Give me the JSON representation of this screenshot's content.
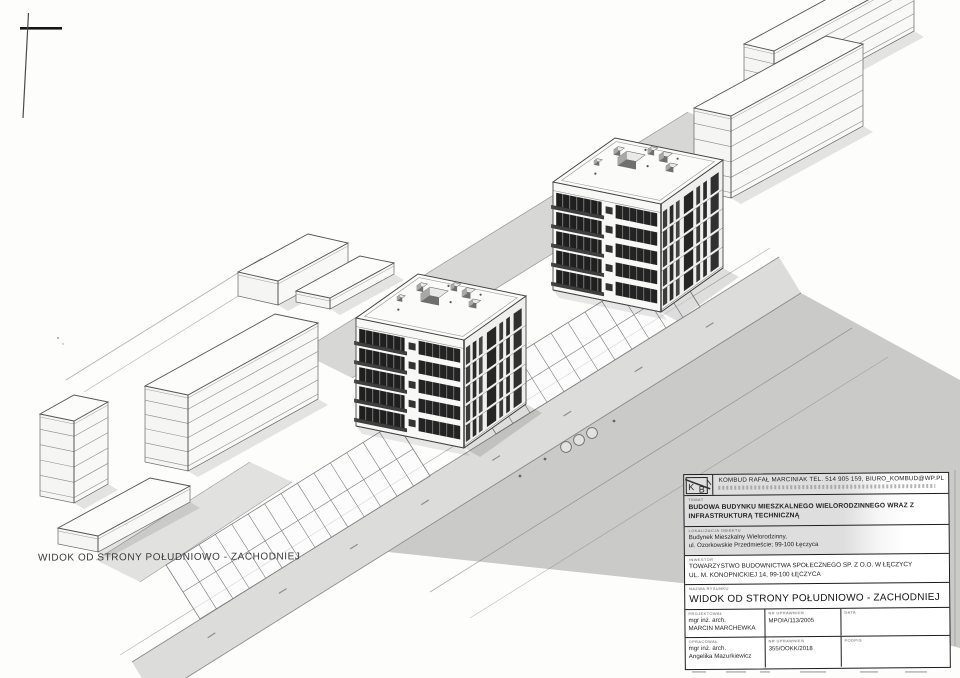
{
  "page": {
    "caption": "WIDOK OD STRONY POŁUDNIOWO - ZACHODNIEJ"
  },
  "title_block": {
    "logo_k": "K",
    "logo_b": "B",
    "contact": "KOMBUD RAFAŁ MARCINIAK TEL. 514 905 159, BIURO_KOMBUD@WP.PL",
    "temat_label": "TEMAT",
    "temat_line1": "BUDOWA BUDYNKU MIESZKALNEGO WIELORODZINNEGO WRAZ Z",
    "temat_line2": "INFRASTRUKTURĄ TECHNICZNĄ",
    "obiekt_label": "LOKALIZACJA OBIEKTU",
    "obiekt_line1": "Budynek Mieszkalny Wielorodzinny,",
    "obiekt_line2": "ul. Ozorkowskie Przedmieście; 99-100 Łęczyca",
    "inwestor_label": "INWESTOR",
    "inwestor_line1": "TOWARZYSTWO BUDOWNICTWA SPOŁECZNEGO SP. Z O.O. W ŁĘCZYCY",
    "inwestor_line2": "UL. M. KONOPNICKIEJ 14, 99-100 ŁĘCZYCA",
    "rysunek_label": "NAZWA RYSUNKU",
    "drawing_title": "WIDOK OD STRONY POŁUDNIOWO - ZACHODNIEJ",
    "projektowal_label": "PROJEKTOWAŁ",
    "projektowal_line1": "mgr inż. arch.",
    "projektowal_line2": "MARCIN MARCHEWKA",
    "upr1_label": "NR UPRAWNIEŃ",
    "upr1_value": "MPOIA/113/2005",
    "data_label": "DATA",
    "opracowal_label": "OPRACOWAŁ",
    "opracowal_line1": "mgr inż. arch.",
    "opracowal_line2": "Angelika Mazurkiewicz",
    "upr2_label": "NR UPRAWNIEŃ",
    "upr2_value": "355/OOKK/2018",
    "podpis_label": "PODPIS"
  },
  "colors": {
    "ink": "#4a4a4a",
    "dark_glass": "#1f1f1f",
    "ground_gray": "rgba(0,0,0,0.20)",
    "road_gray": "rgba(0,0,0,0.13)"
  }
}
